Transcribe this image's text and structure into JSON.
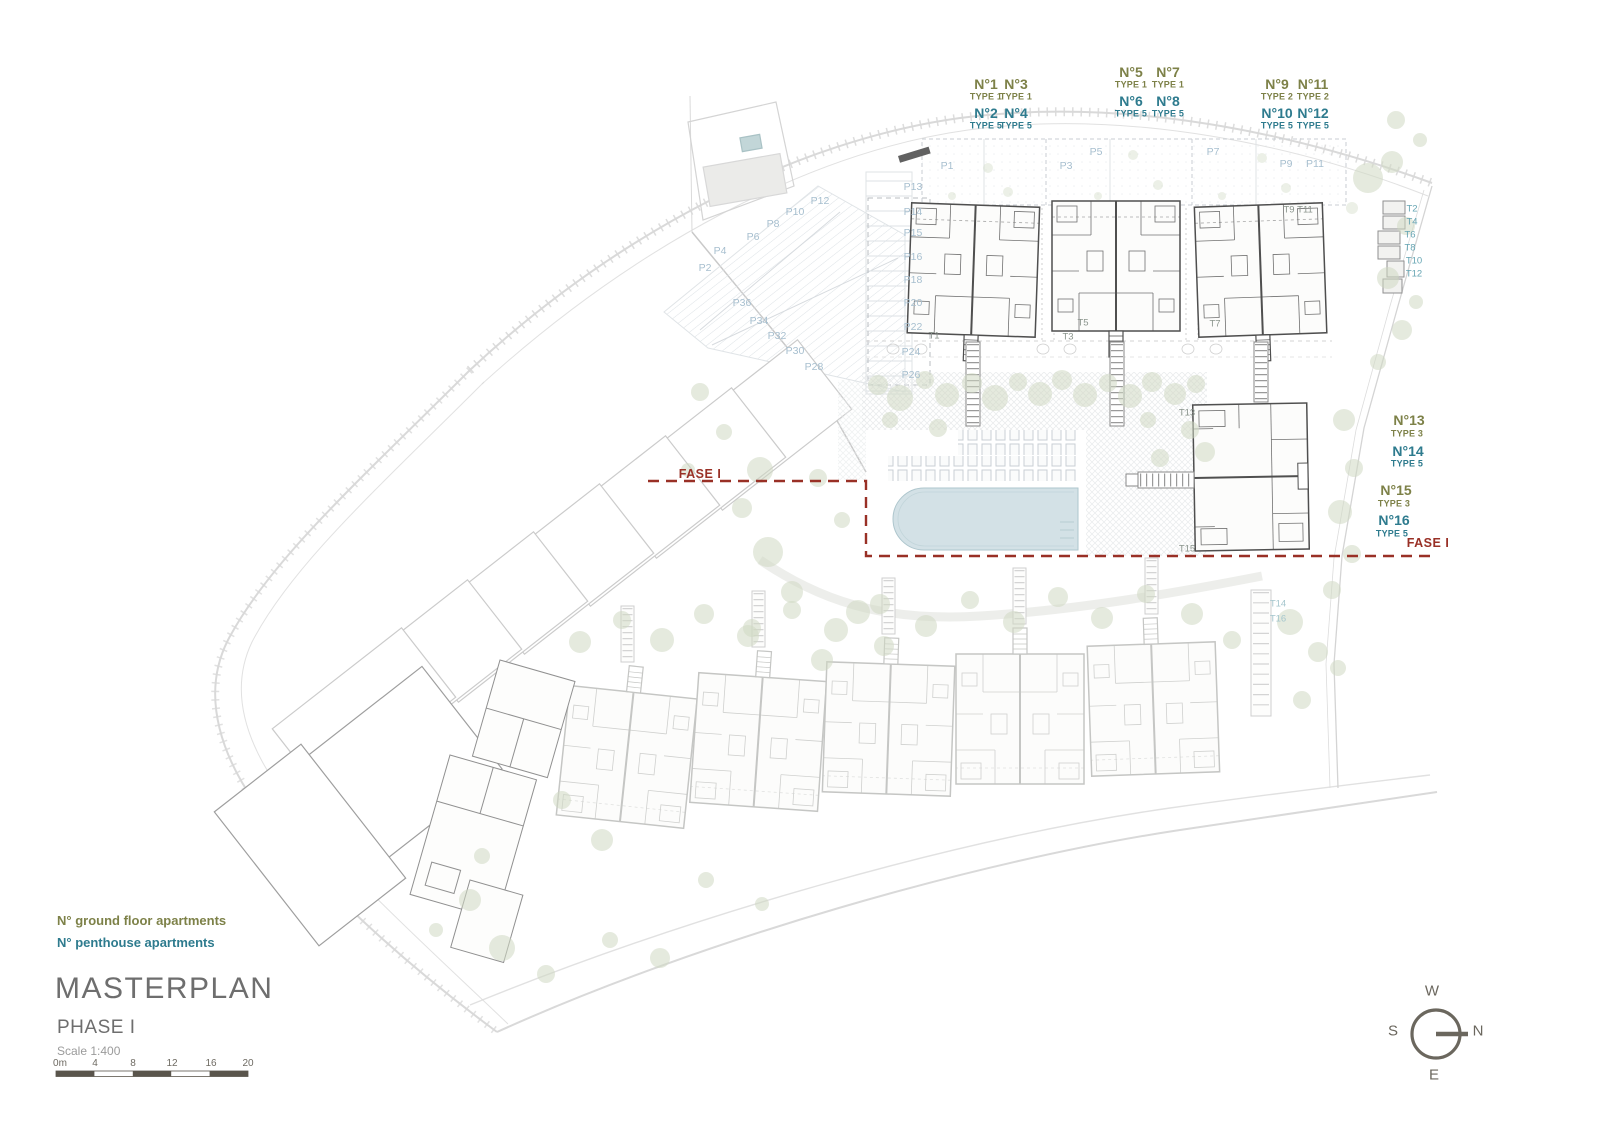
{
  "title_block": {
    "title": "MASTERPLAN",
    "phase": "PHASE I",
    "scale_label": "Scale 1:400"
  },
  "legend": {
    "ground": "N° ground floor apartments",
    "penthouse": "N° penthouse apartments"
  },
  "compass": {
    "west": "W",
    "south": "S",
    "north": "N",
    "east": "E"
  },
  "colors": {
    "ground": "#7d8148",
    "penthouse": "#2e7b8e",
    "fase": "#993026",
    "parking": "#a7bfcf",
    "tgray": "#8b958d",
    "tteal": "#66a5b3",
    "tfaint": "#a5c6cd",
    "tree": "#cfd9c3",
    "pool": "#d3e1e6",
    "plandark": "#4f4f4f",
    "planfaint": "#c5c6c4",
    "road": "#d9d9d9",
    "compass": "#6b675e",
    "scalebar": "#5a554c",
    "title": "#6e6e6e",
    "subtitle": "#9b9b9b"
  },
  "markers": [
    {
      "t": "N°1",
      "x": 986,
      "y": 84,
      "c": "ug"
    },
    {
      "t": "TYPE 1",
      "x": 986,
      "y": 97,
      "c": "us"
    },
    {
      "t": "N°2",
      "x": 986,
      "y": 113,
      "c": "pg"
    },
    {
      "t": "TYPE 5",
      "x": 986,
      "y": 126,
      "c": "ps"
    },
    {
      "t": "N°3",
      "x": 1016,
      "y": 84,
      "c": "ug"
    },
    {
      "t": "TYPE 1",
      "x": 1016,
      "y": 97,
      "c": "us"
    },
    {
      "t": "N°4",
      "x": 1016,
      "y": 113,
      "c": "pg"
    },
    {
      "t": "TYPE 5",
      "x": 1016,
      "y": 126,
      "c": "ps"
    },
    {
      "t": "N°5",
      "x": 1131,
      "y": 72,
      "c": "ug"
    },
    {
      "t": "TYPE 1",
      "x": 1131,
      "y": 85,
      "c": "us"
    },
    {
      "t": "N°6",
      "x": 1131,
      "y": 101,
      "c": "pg"
    },
    {
      "t": "TYPE 5",
      "x": 1131,
      "y": 114,
      "c": "ps"
    },
    {
      "t": "N°7",
      "x": 1168,
      "y": 72,
      "c": "ug"
    },
    {
      "t": "TYPE 1",
      "x": 1168,
      "y": 85,
      "c": "us"
    },
    {
      "t": "N°8",
      "x": 1168,
      "y": 101,
      "c": "pg"
    },
    {
      "t": "TYPE 5",
      "x": 1168,
      "y": 114,
      "c": "ps"
    },
    {
      "t": "N°9",
      "x": 1277,
      "y": 84,
      "c": "ug"
    },
    {
      "t": "TYPE 2",
      "x": 1277,
      "y": 97,
      "c": "us"
    },
    {
      "t": "N°10",
      "x": 1277,
      "y": 113,
      "c": "pg"
    },
    {
      "t": "TYPE 5",
      "x": 1277,
      "y": 126,
      "c": "ps"
    },
    {
      "t": "N°11",
      "x": 1313,
      "y": 84,
      "c": "ug"
    },
    {
      "t": "TYPE 2",
      "x": 1313,
      "y": 97,
      "c": "us"
    },
    {
      "t": "N°12",
      "x": 1313,
      "y": 113,
      "c": "pg"
    },
    {
      "t": "TYPE 5",
      "x": 1313,
      "y": 126,
      "c": "ps"
    },
    {
      "t": "N°13",
      "x": 1409,
      "y": 420,
      "c": "ug"
    },
    {
      "t": "TYPE 3",
      "x": 1407,
      "y": 434,
      "c": "us"
    },
    {
      "t": "N°14",
      "x": 1408,
      "y": 451,
      "c": "pg"
    },
    {
      "t": "TYPE 5",
      "x": 1407,
      "y": 464,
      "c": "ps"
    },
    {
      "t": "N°15",
      "x": 1396,
      "y": 490,
      "c": "ug"
    },
    {
      "t": "TYPE 3",
      "x": 1394,
      "y": 504,
      "c": "us"
    },
    {
      "t": "N°16",
      "x": 1394,
      "y": 520,
      "c": "pg"
    },
    {
      "t": "TYPE 5",
      "x": 1392,
      "y": 534,
      "c": "ps"
    },
    {
      "t": "P1",
      "x": 947,
      "y": 166,
      "c": "pk"
    },
    {
      "t": "P3",
      "x": 1066,
      "y": 166,
      "c": "pk"
    },
    {
      "t": "P5",
      "x": 1096,
      "y": 152,
      "c": "pk"
    },
    {
      "t": "P7",
      "x": 1213,
      "y": 152,
      "c": "pk"
    },
    {
      "t": "P9",
      "x": 1286,
      "y": 164,
      "c": "pk"
    },
    {
      "t": "P11",
      "x": 1315,
      "y": 164,
      "c": "pk"
    },
    {
      "t": "P13",
      "x": 913,
      "y": 187,
      "c": "pk"
    },
    {
      "t": "P14",
      "x": 913,
      "y": 212,
      "c": "pk"
    },
    {
      "t": "P15",
      "x": 913,
      "y": 233,
      "c": "pk"
    },
    {
      "t": "P16",
      "x": 913,
      "y": 257,
      "c": "pk"
    },
    {
      "t": "P18",
      "x": 913,
      "y": 280,
      "c": "pk"
    },
    {
      "t": "P20",
      "x": 913,
      "y": 303,
      "c": "pk"
    },
    {
      "t": "P22",
      "x": 913,
      "y": 327,
      "c": "pk"
    },
    {
      "t": "P24",
      "x": 911,
      "y": 352,
      "c": "pk"
    },
    {
      "t": "P26",
      "x": 911,
      "y": 375,
      "c": "pk"
    },
    {
      "t": "P2",
      "x": 705,
      "y": 268,
      "c": "pk"
    },
    {
      "t": "P4",
      "x": 720,
      "y": 251,
      "c": "pk"
    },
    {
      "t": "P6",
      "x": 753,
      "y": 237,
      "c": "pk"
    },
    {
      "t": "P8",
      "x": 773,
      "y": 224,
      "c": "pk"
    },
    {
      "t": "P10",
      "x": 795,
      "y": 212,
      "c": "pk"
    },
    {
      "t": "P12",
      "x": 820,
      "y": 201,
      "c": "pk"
    },
    {
      "t": "P28",
      "x": 814,
      "y": 367,
      "c": "pk"
    },
    {
      "t": "P30",
      "x": 795,
      "y": 351,
      "c": "pk"
    },
    {
      "t": "P32",
      "x": 777,
      "y": 336,
      "c": "pk"
    },
    {
      "t": "P34",
      "x": 759,
      "y": 321,
      "c": "pk"
    },
    {
      "t": "P36",
      "x": 742,
      "y": 303,
      "c": "pk"
    },
    {
      "t": "T1",
      "x": 934,
      "y": 336,
      "c": "tg"
    },
    {
      "t": "T3",
      "x": 1068,
      "y": 337,
      "c": "tg"
    },
    {
      "t": "T5",
      "x": 1083,
      "y": 323,
      "c": "tg"
    },
    {
      "t": "T7",
      "x": 1215,
      "y": 324,
      "c": "tg"
    },
    {
      "t": "T9",
      "x": 1289,
      "y": 210,
      "c": "tg"
    },
    {
      "t": "T11",
      "x": 1305,
      "y": 210,
      "c": "tg"
    },
    {
      "t": "T13",
      "x": 1187,
      "y": 413,
      "c": "tg"
    },
    {
      "t": "T15",
      "x": 1187,
      "y": 549,
      "c": "tg"
    },
    {
      "t": "T2",
      "x": 1412,
      "y": 209,
      "c": "tt"
    },
    {
      "t": "T4",
      "x": 1412,
      "y": 222,
      "c": "tt"
    },
    {
      "t": "T6",
      "x": 1410,
      "y": 235,
      "c": "tt"
    },
    {
      "t": "T8",
      "x": 1410,
      "y": 248,
      "c": "tt"
    },
    {
      "t": "T10",
      "x": 1414,
      "y": 261,
      "c": "tt"
    },
    {
      "t": "T12",
      "x": 1414,
      "y": 274,
      "c": "tt"
    },
    {
      "t": "T14",
      "x": 1278,
      "y": 604,
      "c": "tf"
    },
    {
      "t": "T16",
      "x": 1278,
      "y": 619,
      "c": "tf"
    },
    {
      "t": "FASE I",
      "x": 700,
      "y": 474,
      "c": "fase"
    },
    {
      "t": "FASE I",
      "x": 1428,
      "y": 543,
      "c": "fase"
    },
    {
      "t": "0m",
      "x": 60,
      "y": 1064,
      "c": "sb"
    },
    {
      "t": "4",
      "x": 95,
      "y": 1064,
      "c": "sb"
    },
    {
      "t": "8",
      "x": 133,
      "y": 1064,
      "c": "sb"
    },
    {
      "t": "12",
      "x": 172,
      "y": 1064,
      "c": "sb"
    },
    {
      "t": "16",
      "x": 211,
      "y": 1064,
      "c": "sb"
    },
    {
      "t": "20",
      "x": 248,
      "y": 1064,
      "c": "sb"
    }
  ]
}
